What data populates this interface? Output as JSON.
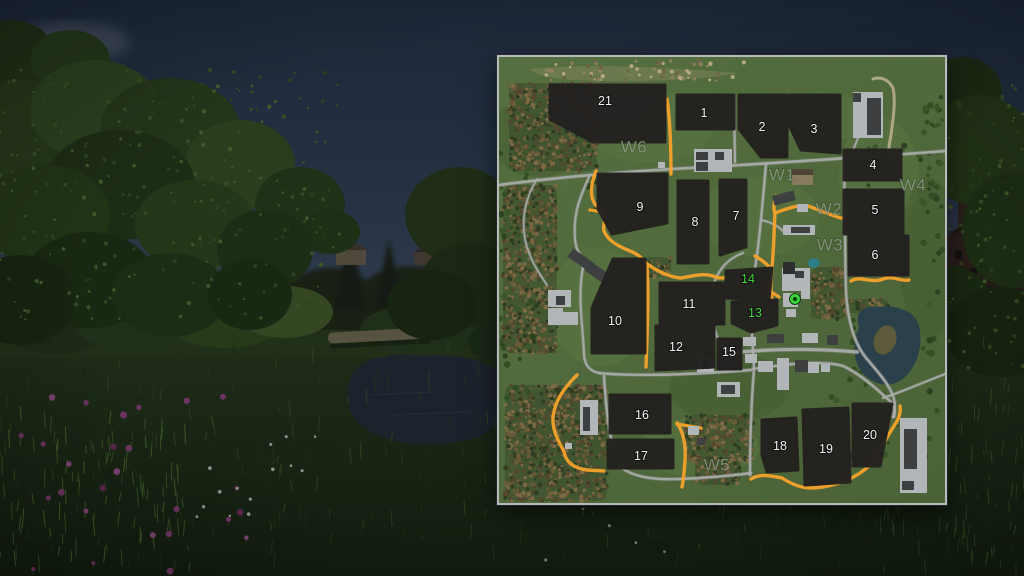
{
  "map": {
    "colors": {
      "ground": "#4e6839",
      "border": "#b6baba",
      "road": "#a9ada9",
      "road_casing": "#7f857d",
      "route": "#f4a22a",
      "trail": "#c4b896",
      "water": "#2a414c",
      "pond": "#2f7d85",
      "field": "#232120",
      "field_label": "#f2f2f2",
      "highlight": "#3fd53f",
      "waypoint": "#8e9b86",
      "marker": "#3bd33b",
      "marker_center": "#0b3a0b"
    },
    "marker": {
      "x": 296,
      "y": 242
    },
    "fields": [
      {
        "label": "1",
        "x": 205,
        "y": 56,
        "highlighted": false,
        "shape": [
          [
            178,
            38
          ],
          [
            235,
            38
          ],
          [
            235,
            72
          ],
          [
            178,
            72
          ]
        ]
      },
      {
        "label": "2",
        "x": 263,
        "y": 70,
        "highlighted": false,
        "shape": [
          [
            240,
            38
          ],
          [
            288,
            38
          ],
          [
            288,
            100
          ],
          [
            262,
            100
          ],
          [
            240,
            72
          ]
        ]
      },
      {
        "label": "3",
        "x": 315,
        "y": 72,
        "highlighted": false,
        "shape": [
          [
            291,
            38
          ],
          [
            341,
            38
          ],
          [
            341,
            96
          ],
          [
            302,
            93
          ],
          [
            291,
            70
          ]
        ]
      },
      {
        "label": "4",
        "x": 374,
        "y": 108,
        "highlighted": false,
        "shape": [
          [
            345,
            93
          ],
          [
            402,
            93
          ],
          [
            402,
            123
          ],
          [
            345,
            123
          ]
        ]
      },
      {
        "label": "5",
        "x": 376,
        "y": 153,
        "highlighted": false,
        "shape": [
          [
            345,
            133
          ],
          [
            404,
            133
          ],
          [
            404,
            177
          ],
          [
            345,
            177
          ]
        ]
      },
      {
        "label": "6",
        "x": 376,
        "y": 198,
        "highlighted": false,
        "shape": [
          [
            350,
            179
          ],
          [
            409,
            179
          ],
          [
            409,
            218
          ],
          [
            350,
            218
          ]
        ]
      },
      {
        "label": "7",
        "x": 237,
        "y": 159,
        "highlighted": false,
        "shape": [
          [
            221,
            123
          ],
          [
            247,
            123
          ],
          [
            247,
            190
          ],
          [
            221,
            198
          ]
        ]
      },
      {
        "label": "8",
        "x": 196,
        "y": 165,
        "highlighted": false,
        "shape": [
          [
            179,
            124
          ],
          [
            209,
            124
          ],
          [
            209,
            206
          ],
          [
            179,
            206
          ]
        ]
      },
      {
        "label": "9",
        "x": 141,
        "y": 150,
        "highlighted": false,
        "shape": [
          [
            99,
            117
          ],
          [
            168,
            117
          ],
          [
            168,
            166
          ],
          [
            113,
            177
          ],
          [
            99,
            152
          ]
        ]
      },
      {
        "label": "10",
        "x": 116,
        "y": 264,
        "highlighted": false,
        "shape": [
          [
            114,
            202
          ],
          [
            146,
            202
          ],
          [
            146,
            296
          ],
          [
            93,
            296
          ],
          [
            93,
            251
          ]
        ]
      },
      {
        "label": "11",
        "x": 190,
        "y": 247,
        "highlighted": false,
        "shape": [
          [
            161,
            226
          ],
          [
            225,
            226
          ],
          [
            225,
            267
          ],
          [
            161,
            267
          ]
        ]
      },
      {
        "label": "12",
        "x": 177,
        "y": 290,
        "highlighted": false,
        "shape": [
          [
            157,
            269
          ],
          [
            215,
            269
          ],
          [
            215,
            310
          ],
          [
            157,
            313
          ]
        ]
      },
      {
        "label": "13",
        "x": 256,
        "y": 256,
        "highlighted": true,
        "shape": [
          [
            233,
            245
          ],
          [
            278,
            243
          ],
          [
            278,
            268
          ],
          [
            252,
            275
          ],
          [
            233,
            266
          ]
        ]
      },
      {
        "label": "14",
        "x": 249,
        "y": 222,
        "highlighted": true,
        "shape": [
          [
            227,
            214
          ],
          [
            273,
            211
          ],
          [
            270,
            243
          ],
          [
            227,
            241
          ]
        ]
      },
      {
        "label": "15",
        "x": 230,
        "y": 295,
        "highlighted": false,
        "shape": [
          [
            219,
            282
          ],
          [
            242,
            282
          ],
          [
            242,
            312
          ],
          [
            219,
            312
          ]
        ]
      },
      {
        "label": "16",
        "x": 143,
        "y": 358,
        "highlighted": false,
        "shape": [
          [
            111,
            338
          ],
          [
            171,
            338
          ],
          [
            171,
            376
          ],
          [
            111,
            376
          ]
        ]
      },
      {
        "label": "17",
        "x": 142,
        "y": 399,
        "highlighted": false,
        "shape": [
          [
            109,
            383
          ],
          [
            174,
            383
          ],
          [
            174,
            411
          ],
          [
            109,
            411
          ]
        ]
      },
      {
        "label": "18",
        "x": 281,
        "y": 389,
        "highlighted": false,
        "shape": [
          [
            263,
            363
          ],
          [
            297,
            361
          ],
          [
            299,
            413
          ],
          [
            268,
            415
          ],
          [
            263,
            398
          ]
        ]
      },
      {
        "label": "19",
        "x": 327,
        "y": 392,
        "highlighted": false,
        "shape": [
          [
            304,
            353
          ],
          [
            349,
            351
          ],
          [
            351,
            425
          ],
          [
            306,
            428
          ]
        ]
      },
      {
        "label": "20",
        "x": 371,
        "y": 378,
        "highlighted": false,
        "shape": [
          [
            354,
            347
          ],
          [
            393,
            347
          ],
          [
            381,
            409
          ],
          [
            354,
            409
          ]
        ]
      },
      {
        "label": "21",
        "x": 106,
        "y": 44,
        "highlighted": false,
        "shape": [
          [
            51,
            28
          ],
          [
            166,
            28
          ],
          [
            166,
            85
          ],
          [
            94,
            85
          ],
          [
            51,
            62
          ]
        ]
      }
    ],
    "waypoints": [
      {
        "label": "W1",
        "x": 283,
        "y": 118
      },
      {
        "label": "W2",
        "x": 330,
        "y": 152
      },
      {
        "label": "W3",
        "x": 331,
        "y": 188
      },
      {
        "label": "W4",
        "x": 414,
        "y": 128
      },
      {
        "label": "W5",
        "x": 218,
        "y": 408
      },
      {
        "label": "W6",
        "x": 135,
        "y": 90
      }
    ]
  }
}
